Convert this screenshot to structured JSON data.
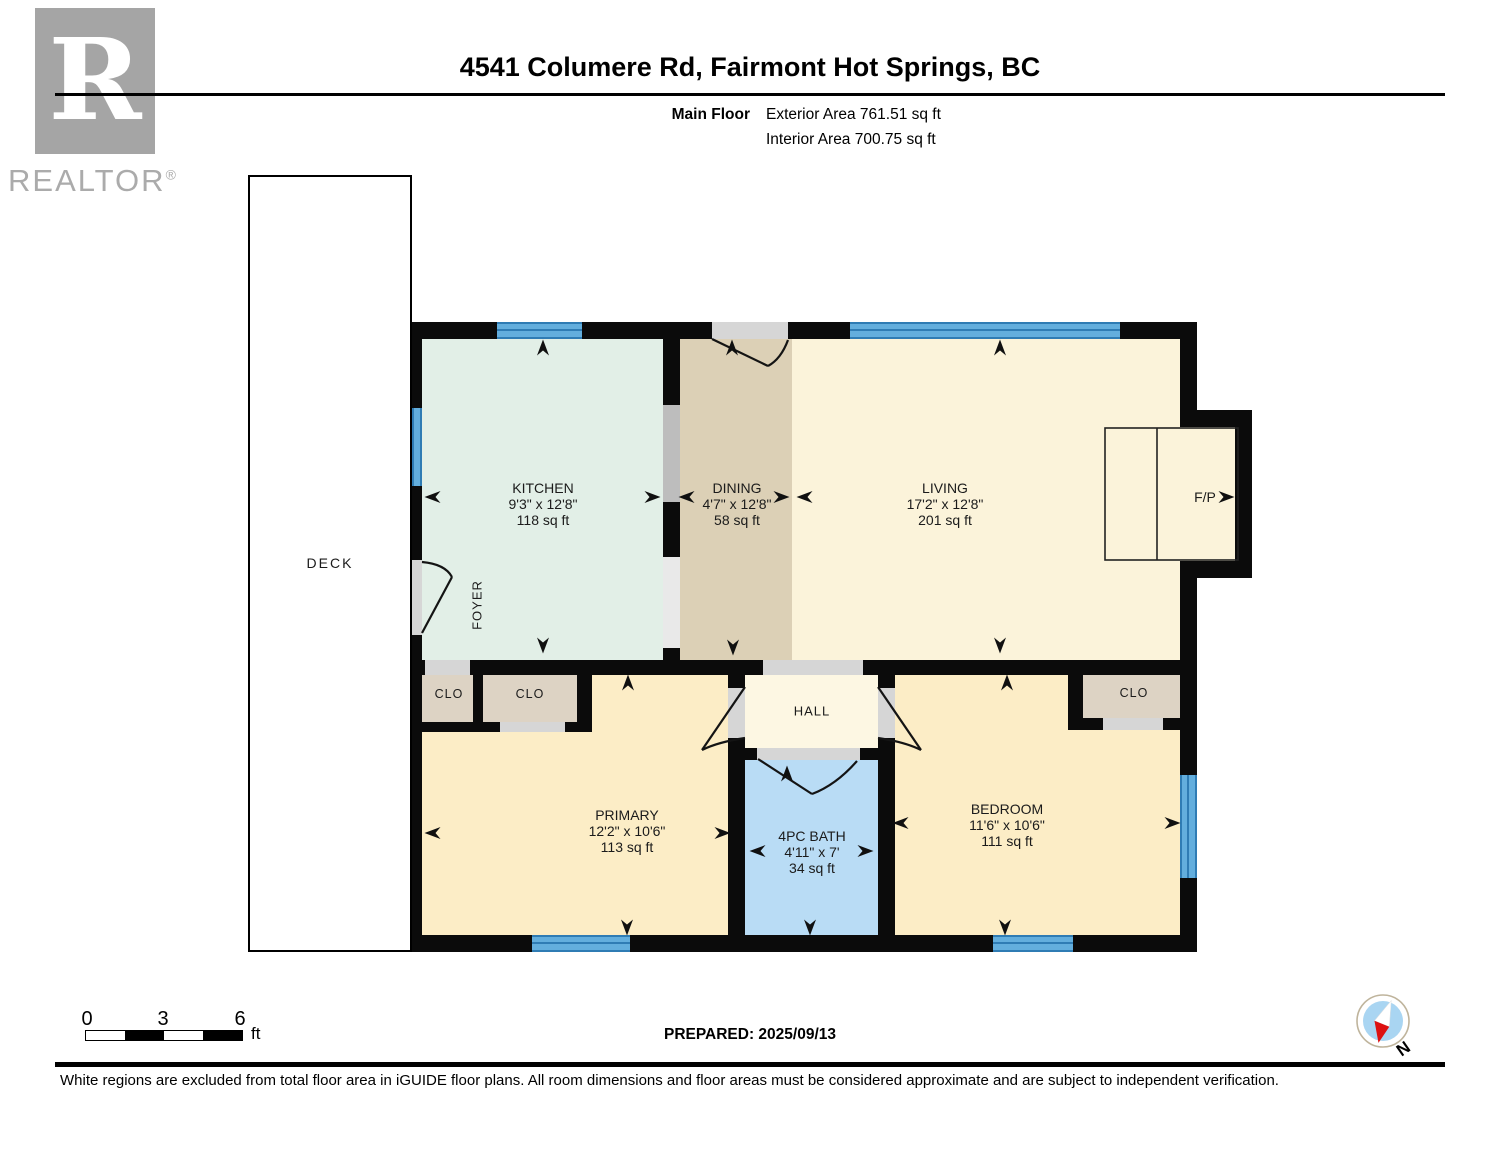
{
  "header": {
    "title": "4541 Columere Rd, Fairmont Hot Springs, BC",
    "floor_label": "Main Floor",
    "exterior_area": "Exterior Area 761.51 sq ft",
    "interior_area": "Interior Area 700.75 sq ft"
  },
  "logo": {
    "letter": "R",
    "brand": "REALTOR",
    "reg": "®"
  },
  "rooms": [
    {
      "name": "KITCHEN",
      "dims": "9'3\" x 12'8\"",
      "area": "118 sq ft"
    },
    {
      "name": "DINING",
      "dims": "4'7\" x 12'8\"",
      "area": "58 sq ft"
    },
    {
      "name": "LIVING",
      "dims": "17'2\" x 12'8\"",
      "area": "201 sq ft"
    },
    {
      "name": "PRIMARY",
      "dims": "12'2\" x 10'6\"",
      "area": "113 sq ft"
    },
    {
      "name": "4PC BATH",
      "dims": "4'11\" x 7'",
      "area": "34 sq ft"
    },
    {
      "name": "BEDROOM",
      "dims": "11'6\" x 10'6\"",
      "area": "111 sq ft"
    }
  ],
  "labels": {
    "deck": "DECK",
    "foyer": "FOYER",
    "hall": "HALL",
    "fireplace": "F/P",
    "closet": "CLO"
  },
  "scale_bar": {
    "tick0": "0",
    "tick1": "3",
    "tick2": "6",
    "unit": "ft"
  },
  "footer": {
    "prepared": "PREPARED: 2025/09/13",
    "disclaimer": "White regions are excluded from total floor area in iGUIDE floor plans. All room dimensions and floor areas must be considered approximate and are subject to independent verification.",
    "compass_north": "N"
  },
  "colors": {
    "wall": "#0b0b0b",
    "kitchen": "#e2efe7",
    "dining": "#dcd0b6",
    "living": "#fbf3da",
    "hall": "#fdf7e3",
    "bedroom": "#fcedc6",
    "bath": "#b9dcf5",
    "closet": "#ddd3c4",
    "window_light": "#63aedd",
    "window_dark": "#2f7cb4",
    "opening": "#d6d6d6",
    "opening_mid": "#bdbdbd",
    "opening_light": "#e9e9e9",
    "logo_gray": "#a5a5a5",
    "compass_blue": "#a9d5f2",
    "compass_red": "#dd1111",
    "compass_ring": "#bfb49c"
  }
}
